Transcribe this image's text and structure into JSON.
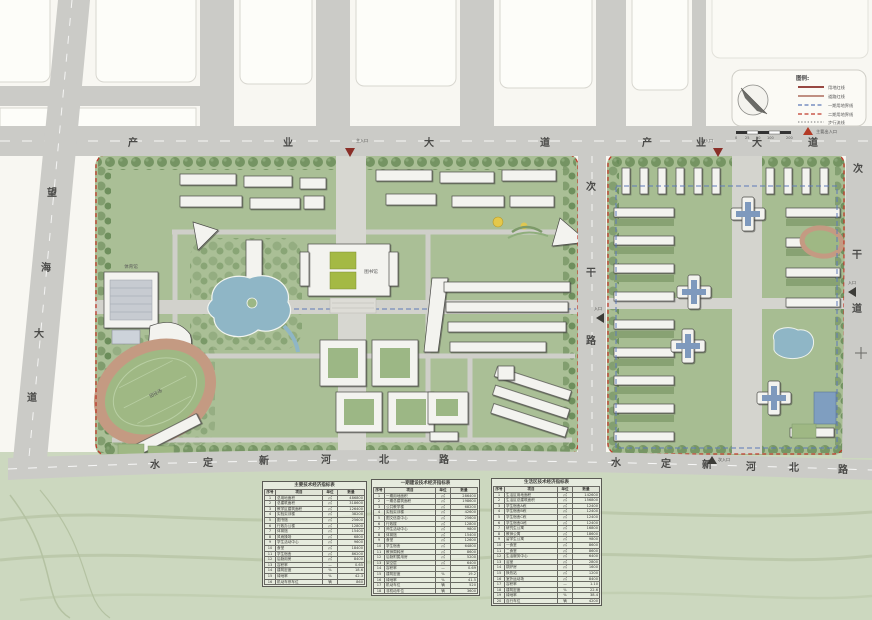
{
  "roads": {
    "industry_w": {
      "name": "产业大道",
      "chars": [
        "产",
        "业",
        "大",
        "道"
      ]
    },
    "industry_e": {
      "name": "产业大道",
      "chars": [
        "产",
        "业",
        "大",
        "道"
      ]
    },
    "shuiding_w": {
      "name": "水定新河北路",
      "chars": [
        "水",
        "定",
        "新",
        "河",
        "北",
        "路"
      ]
    },
    "shuiding_e": {
      "name": "水定新河北路",
      "chars": [
        "水",
        "定",
        "新",
        "河",
        "北",
        "路"
      ]
    },
    "wanghai": {
      "name": "望海大道",
      "chars": [
        "望",
        "海",
        "大",
        "道"
      ]
    },
    "middle": {
      "name": "次干路",
      "chars": [
        "次",
        "干",
        "路"
      ]
    },
    "east": {
      "name": "次干道",
      "chars": [
        "次",
        "干",
        "道"
      ]
    }
  },
  "entrances": {
    "main": "主入口",
    "secondary": "次入口",
    "side": "入口"
  },
  "map": {
    "labels": {
      "library": "图书馆",
      "stadium": "田径场",
      "gym": "体育馆"
    }
  },
  "legend": {
    "title": "图例:",
    "items": [
      {
        "label": "用地红线"
      },
      {
        "label": "道路红线"
      },
      {
        "label": "一期用地界线"
      },
      {
        "label": "二期用地界线"
      },
      {
        "label": "步行流线"
      },
      {
        "label": "主要出入口"
      }
    ],
    "scale_labels": [
      "0",
      "25",
      "50",
      "100",
      "200"
    ]
  },
  "colors": {
    "boundary_red": "#c0392b",
    "axis_blue": "#5d79b8",
    "green_base": "#aabf96",
    "road_grey": "#cbcbc7",
    "water": "#8fb6c6",
    "track_tan": "#c49a82"
  },
  "tables": {
    "t1": {
      "title": "主要技术经济指标表",
      "columns": [
        "序号",
        "项目",
        "单位",
        "数量"
      ],
      "rows": [
        [
          "1",
          "总用地面积",
          "㎡",
          "486800"
        ],
        [
          "2",
          "总建筑面积",
          "㎡",
          "318600"
        ],
        [
          "3",
          "教学区建筑面积",
          "㎡",
          "126400"
        ],
        [
          "4",
          "实验实训楼",
          "㎡",
          "38200"
        ],
        [
          "5",
          "图书馆",
          "㎡",
          "25600"
        ],
        [
          "6",
          "行政办公楼",
          "㎡",
          "12800"
        ],
        [
          "7",
          "体育馆",
          "㎡",
          "15400"
        ],
        [
          "8",
          "风雨操场",
          "㎡",
          "6800"
        ],
        [
          "9",
          "学生活动中心",
          "㎡",
          "9600"
        ],
        [
          "10",
          "食堂",
          "㎡",
          "18400"
        ],
        [
          "11",
          "学生宿舍",
          "㎡",
          "86200"
        ],
        [
          "12",
          "后勤用房",
          "㎡",
          "8400"
        ],
        [
          "13",
          "容积率",
          "—",
          "0.65"
        ],
        [
          "14",
          "建筑密度",
          "%",
          "18.6"
        ],
        [
          "15",
          "绿地率",
          "%",
          "42.3"
        ],
        [
          "16",
          "机动车停车位",
          "辆",
          "860"
        ]
      ]
    },
    "t2": {
      "title": "一期建设技术经济指标表",
      "columns": [
        "序号",
        "项目",
        "单位",
        "数量"
      ],
      "rows": [
        [
          "1",
          "一期用地面积",
          "㎡",
          "286400"
        ],
        [
          "2",
          "一期总建筑面积",
          "㎡",
          "198600"
        ],
        [
          "3",
          "公共教学楼",
          "㎡",
          "68200"
        ],
        [
          "4",
          "实验实训楼",
          "㎡",
          "42600"
        ],
        [
          "5",
          "图文信息中心",
          "㎡",
          "25600"
        ],
        [
          "6",
          "行政楼",
          "㎡",
          "12800"
        ],
        [
          "7",
          "师生活动中心",
          "㎡",
          "9800"
        ],
        [
          "8",
          "体育馆",
          "㎡",
          "15400"
        ],
        [
          "9",
          "食堂",
          "㎡",
          "12600"
        ],
        [
          "10",
          "学生宿舍",
          "㎡",
          "64800"
        ],
        [
          "11",
          "教师周转房",
          "㎡",
          "8600"
        ],
        [
          "12",
          "后勤附属用房",
          "㎡",
          "5200"
        ],
        [
          "13",
          "架空层",
          "㎡",
          "6400"
        ],
        [
          "14",
          "容积率",
          "—",
          "0.69"
        ],
        [
          "15",
          "建筑密度",
          "%",
          "19.2"
        ],
        [
          "16",
          "绿地率",
          "%",
          "41.5"
        ],
        [
          "17",
          "机动车位",
          "辆",
          "520"
        ],
        [
          "18",
          "非机动车位",
          "辆",
          "3600"
        ]
      ]
    },
    "t3": {
      "title": "生活区技术经济指标表",
      "columns": [
        "序号",
        "项目",
        "单位",
        "数量"
      ],
      "rows": [
        [
          "1",
          "生活区用地面积",
          "㎡",
          "142600"
        ],
        [
          "2",
          "生活区总建筑面积",
          "㎡",
          "156800"
        ],
        [
          "3",
          "学生宿舍A栋",
          "㎡",
          "12400"
        ],
        [
          "4",
          "学生宿舍B栋",
          "㎡",
          "12400"
        ],
        [
          "5",
          "学生宿舍C栋",
          "㎡",
          "12400"
        ],
        [
          "6",
          "学生宿舍D栋",
          "㎡",
          "12400"
        ],
        [
          "7",
          "研究生公寓",
          "㎡",
          "16800"
        ],
        [
          "8",
          "教师公寓",
          "㎡",
          "18600"
        ],
        [
          "9",
          "留学生公寓",
          "㎡",
          "9800"
        ],
        [
          "10",
          "一食堂",
          "㎡",
          "8600"
        ],
        [
          "11",
          "二食堂",
          "㎡",
          "8600"
        ],
        [
          "12",
          "生活服务中心",
          "㎡",
          "6400"
        ],
        [
          "13",
          "浴室",
          "㎡",
          "2800"
        ],
        [
          "14",
          "锅炉房",
          "㎡",
          "1600"
        ],
        [
          "15",
          "换热站",
          "㎡",
          "1200"
        ],
        [
          "16",
          "室外运动场",
          "㎡",
          "8400"
        ],
        [
          "17",
          "容积率",
          "—",
          "1.10"
        ],
        [
          "18",
          "建筑密度",
          "%",
          "22.6"
        ],
        [
          "19",
          "绿地率",
          "%",
          "38.4"
        ],
        [
          "20",
          "自行车位",
          "辆",
          "4200"
        ]
      ]
    }
  }
}
